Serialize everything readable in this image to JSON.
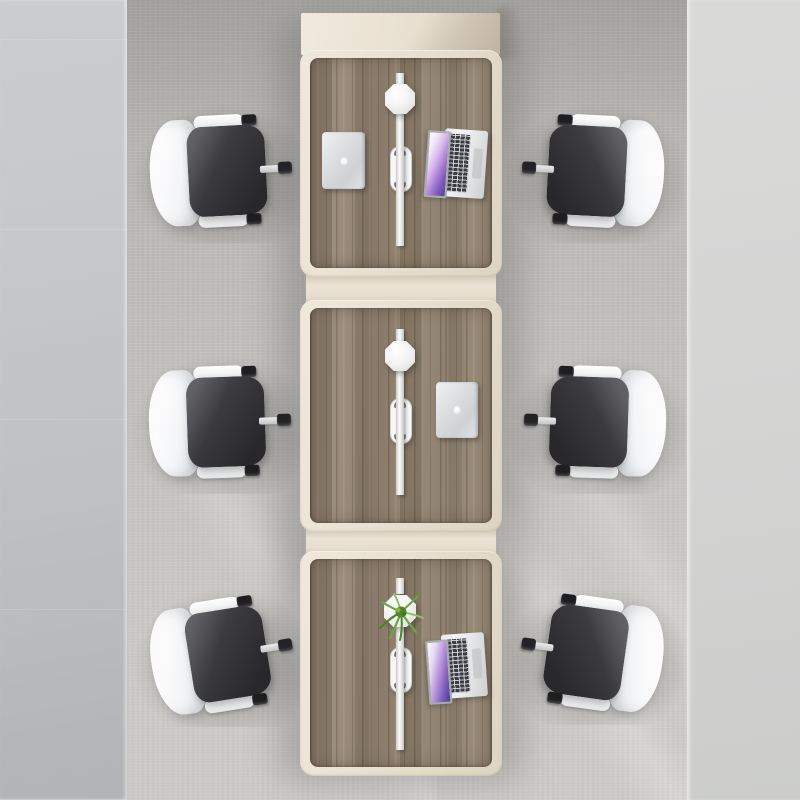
{
  "scene": {
    "description": "Top-down view of a shared office workstation: three wood-top desks joined in a column on a grey rug, six white-and-black swivel chairs, two closed MacBooks, two open laptops, two octagonal desk lamps, a potted plant and cable grommets on the centre divider",
    "counts": {
      "desks": 3,
      "chairs": 6,
      "closed_laptops": 2,
      "open_laptops": 2,
      "desk_lamps": 2,
      "plants": 1,
      "cable_grommets": 3
    },
    "colors": {
      "floor_left": "#bfc0c2",
      "floor_right": "#d5d5d4",
      "rug": "#c2c0bd",
      "desk_frame": "#e9e0d1",
      "desk_wood": "#8d7e6d",
      "chair_seat": "#28282b",
      "chair_back": "#f4f5f6",
      "laptop_silver": "#d9dbdd",
      "keyboard_keys": "#3a3d42",
      "screen_gradient_start": "#fdfdfe",
      "screen_gradient_end": "#5a4099",
      "plant_green": "#69a83d"
    },
    "objects": [
      {
        "name": "desk-1",
        "items": [
          "closed-macbook",
          "open-laptop",
          "desk-lamp",
          "cable-grommet"
        ]
      },
      {
        "name": "desk-2",
        "items": [
          "closed-macbook",
          "desk-lamp",
          "cable-grommet"
        ]
      },
      {
        "name": "desk-3",
        "items": [
          "open-laptop",
          "plant",
          "cable-grommet"
        ]
      },
      {
        "name": "chairs",
        "positions": [
          "top-left",
          "top-right",
          "middle-left",
          "middle-right",
          "bottom-left",
          "bottom-right"
        ]
      }
    ]
  }
}
